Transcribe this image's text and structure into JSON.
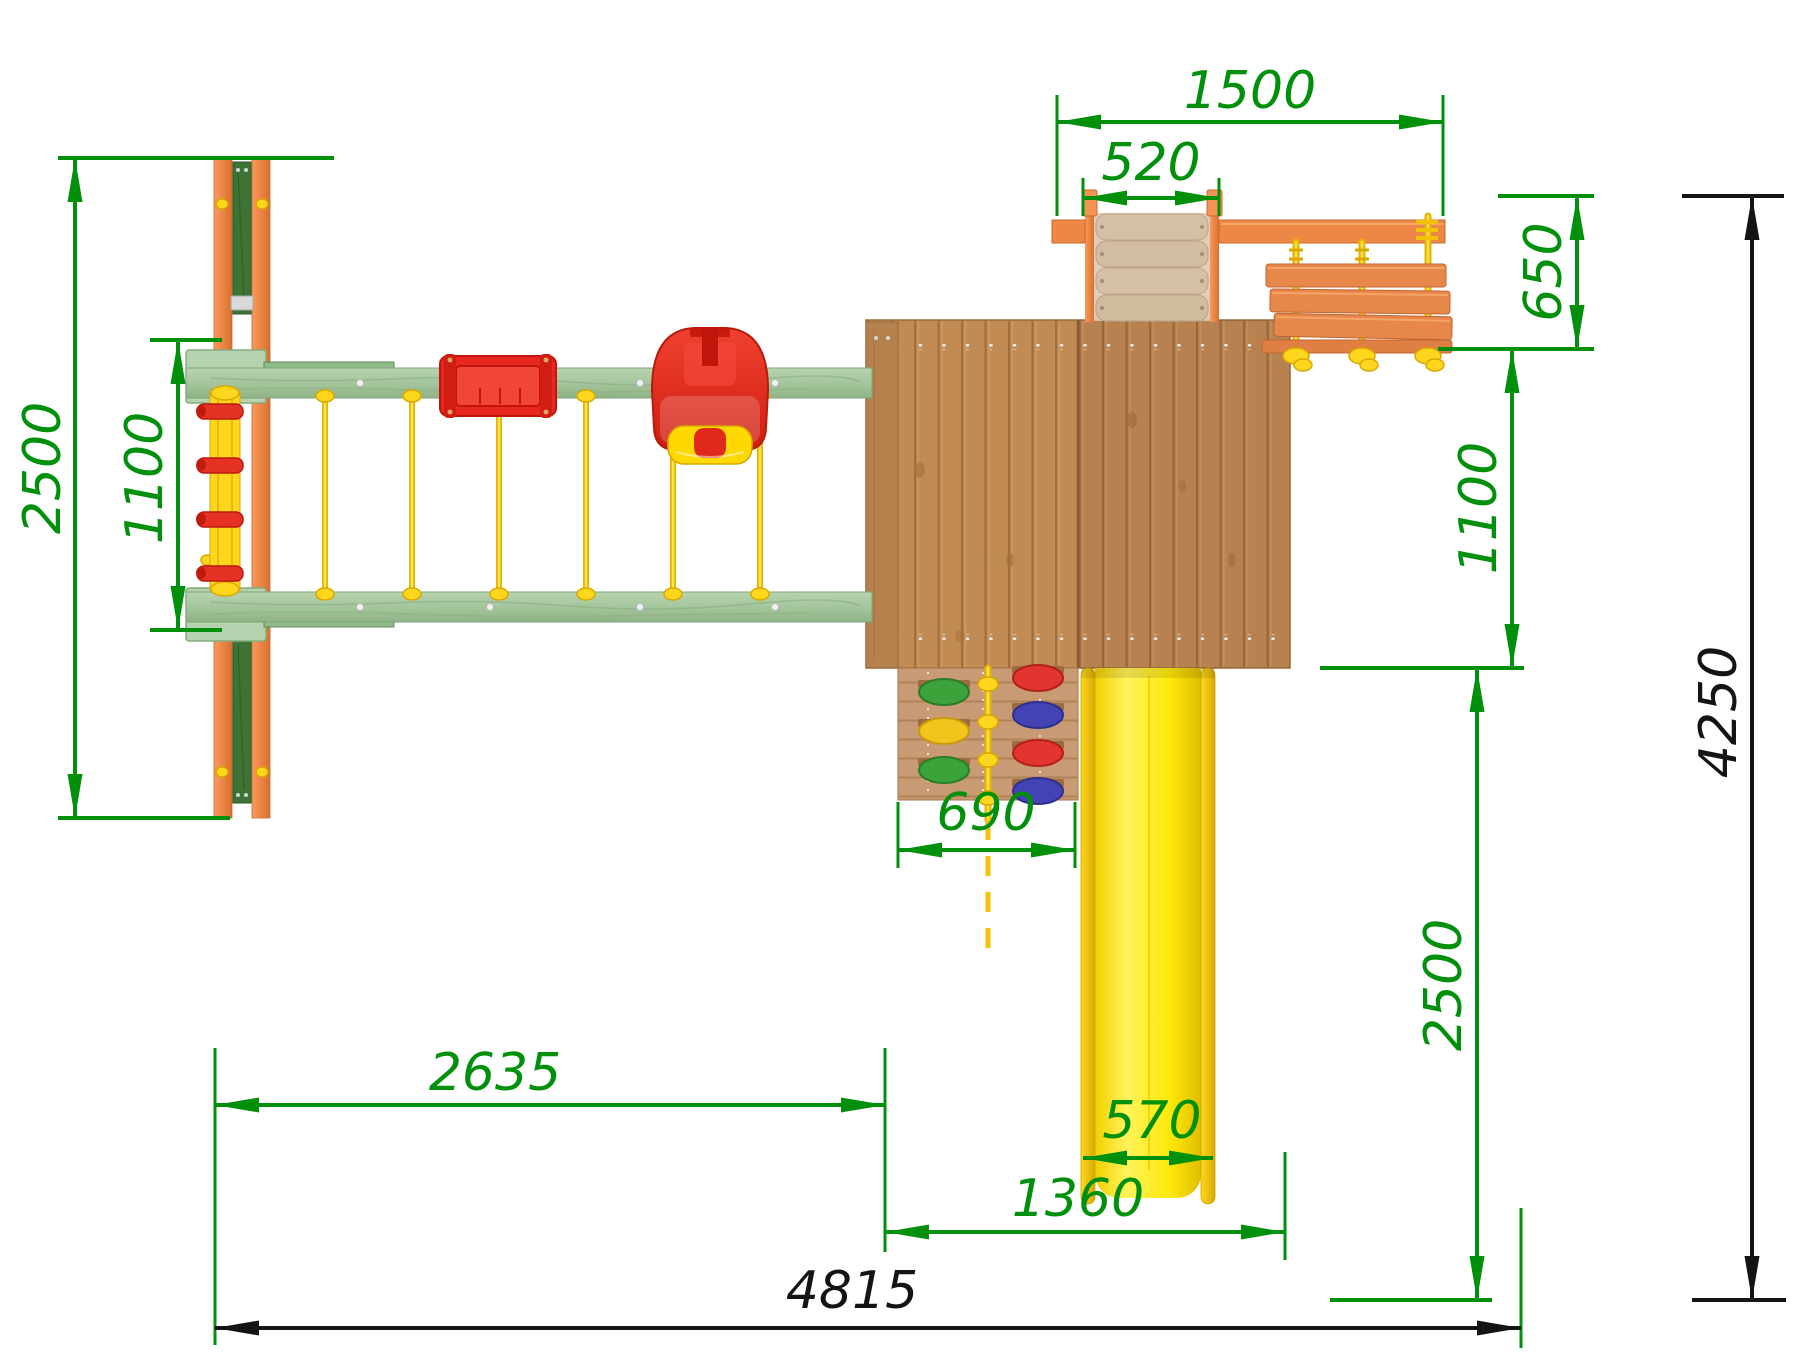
{
  "drawing": {
    "kind": "playground-set top view technical drawing",
    "units": "mm"
  },
  "colors": {
    "dimension": "#00900b",
    "dimension_total": "#141414",
    "beam_green": "#a9c9a1",
    "post_orange": "#ef8a4d",
    "brace_green": "#3d7334",
    "rope_yellow": "#ffd300",
    "seat_red": "#e8281e",
    "deck_wood": "#c38b54",
    "slide_yellow": "#ffec00",
    "ladder_wood": "#e8874a",
    "wall_wood": "#c99b74",
    "ramp_wood": "#dcc9b2"
  },
  "dimensions": {
    "top": {
      "overall": "1500",
      "ramp_width": "520"
    },
    "right": {
      "ladder_depth": "650",
      "deck_depth": "1100",
      "slide_run": "2500",
      "total_depth": "4250"
    },
    "left": {
      "frame_depth": "2500",
      "beam_gap": "1100"
    },
    "middle": {
      "climb_wall_width": "690",
      "slide_width": "570"
    },
    "bottom": {
      "swing_section": "2635",
      "tower_section": "1360",
      "total_width": "4815"
    }
  }
}
